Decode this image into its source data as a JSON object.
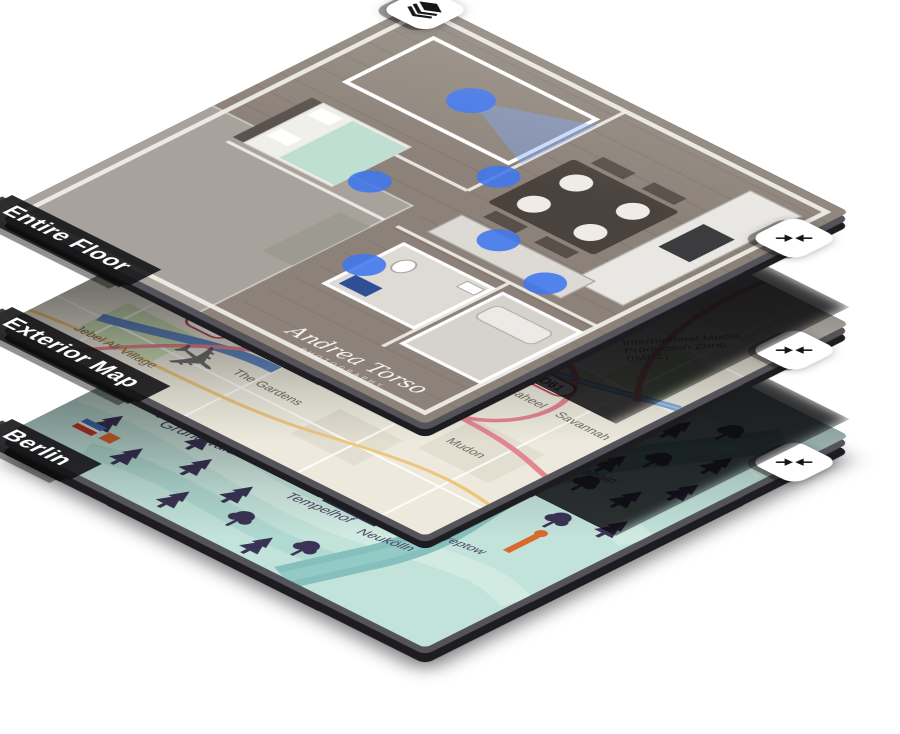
{
  "page": {
    "background": "#ffffff"
  },
  "layers_panel": {
    "description": "isometric stacked map layers selector",
    "colors": {
      "label_bar_bg": "#100f12",
      "label_text": "#ffffff",
      "button_bg": "#ffffff",
      "button_icon": "#161616",
      "scan_point_blue": "#3f76ee",
      "street_map_bg": "#edeadd",
      "berlin_bg": "#c2e3da",
      "berlin_water": "#86c0bd",
      "berlin_tree": "#3a3355",
      "berlin_landmark_orange": "#d9692f"
    },
    "buttons": {
      "layers_toggle_icon": "layers-icon",
      "collapse_icon": "collapse-horizontal-icon"
    },
    "layers": [
      {
        "label": "Entire Floor",
        "type": "floorplan",
        "watermark": {
          "name": "Andrea Torso",
          "subtitle": "PHOTOGRAPHY"
        }
      },
      {
        "label": "Exterior Map",
        "type": "street-map",
        "map_labels": {
          "jebel": "Jebel Ali Village",
          "gardens": "The Gardens",
          "impz_lines": [
            "International Media",
            "Production Zone",
            "(IMPZ)"
          ],
          "saheel": "Saheel",
          "hattan": "Hattan",
          "savannah": "Savannah",
          "mudon": "Mudon"
        },
        "road_badges": {
          "badge1": "D61",
          "badge2": "D61"
        }
      },
      {
        "label": "Berlin",
        "type": "illustrated-map",
        "map_labels": {
          "grunewald": "Grunewald",
          "schoeneberg": "Schöneberg",
          "tempelhof": "Tempelhof",
          "neukoelln": "Neukölln",
          "treptow": "Treptow",
          "kreuzberg": "Kreuzberg",
          "friedrichshain": "Friedrichshain"
        }
      }
    ]
  }
}
